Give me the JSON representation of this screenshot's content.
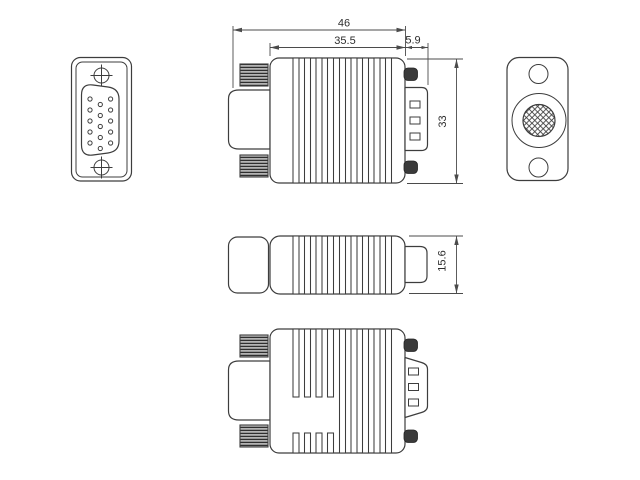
{
  "drawing": {
    "dimensions": {
      "overall_length": "46",
      "body_length": "35.5",
      "plug_depth": "5.9",
      "body_height": "33",
      "body_thickness": "15.6"
    },
    "colors": {
      "line": "#3d3d3d",
      "dimension_line": "#4b4b4b",
      "background": "#ffffff"
    }
  }
}
